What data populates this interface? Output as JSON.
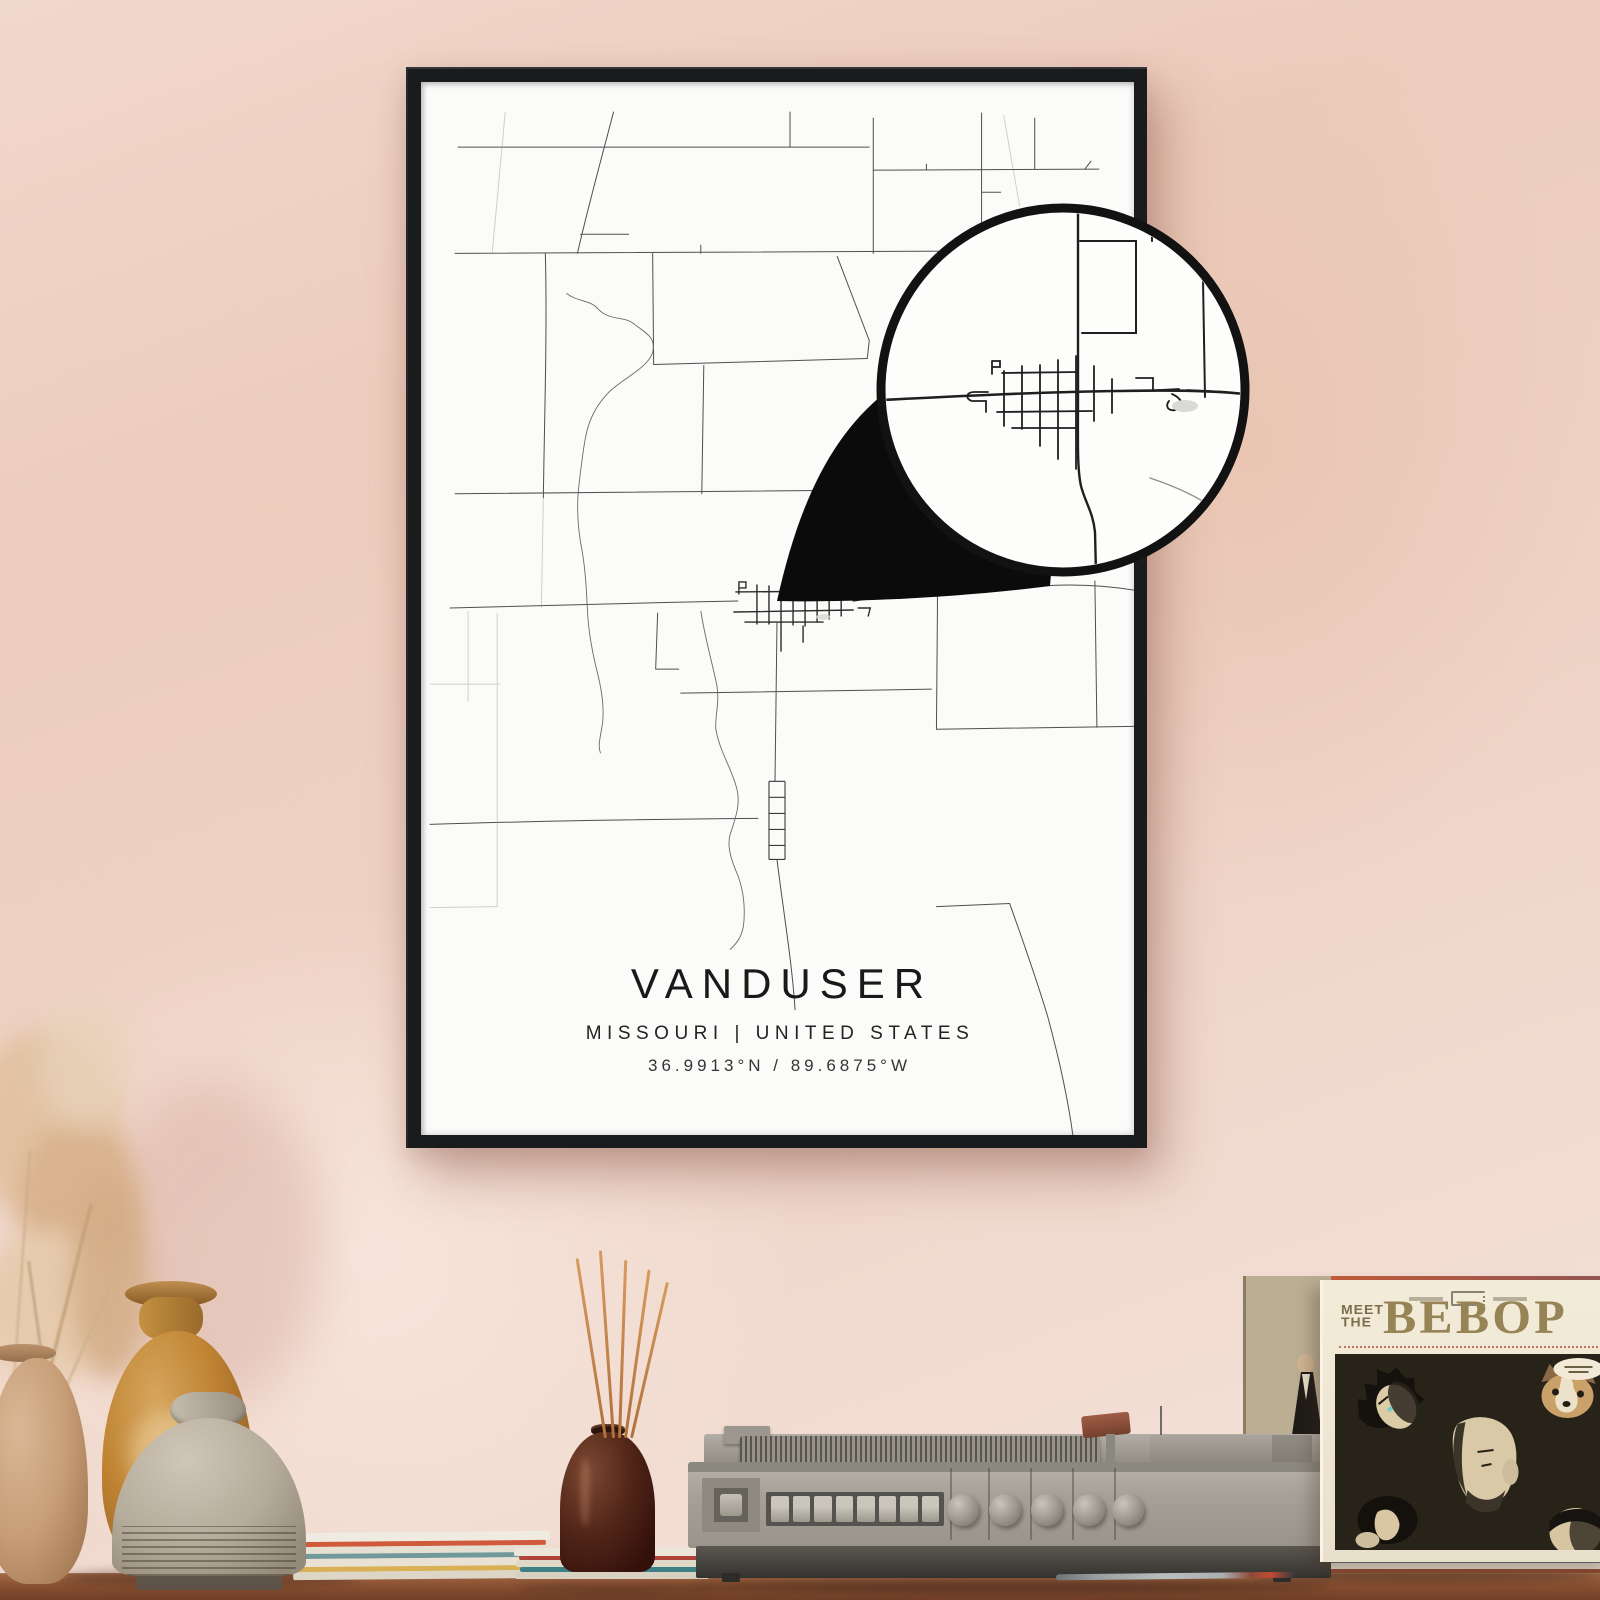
{
  "poster": {
    "title": "VANDUSER",
    "subtitle": "MISSOURI | UNITED STATES",
    "coordinates": "36.9913°N / 89.6875°W"
  },
  "record_sleeve": {
    "title_top": "MEET",
    "title_top2": "THE",
    "title_main": "BEBOP"
  },
  "record_player": {
    "square_buttons": 8,
    "round_knobs": 5
  },
  "colors": {
    "wall_top": "#ecc9b8",
    "wall_bottom": "#f5e6e0",
    "frame": "#1a1b1d",
    "paper": "#fbfbf9",
    "map_line": "#4f4f4f",
    "callout_black": "#0b0b0b",
    "table": "#8c5233",
    "sleeve_title": "#968356",
    "reed": "#c9853f",
    "incense_bottle": "#54281a"
  }
}
